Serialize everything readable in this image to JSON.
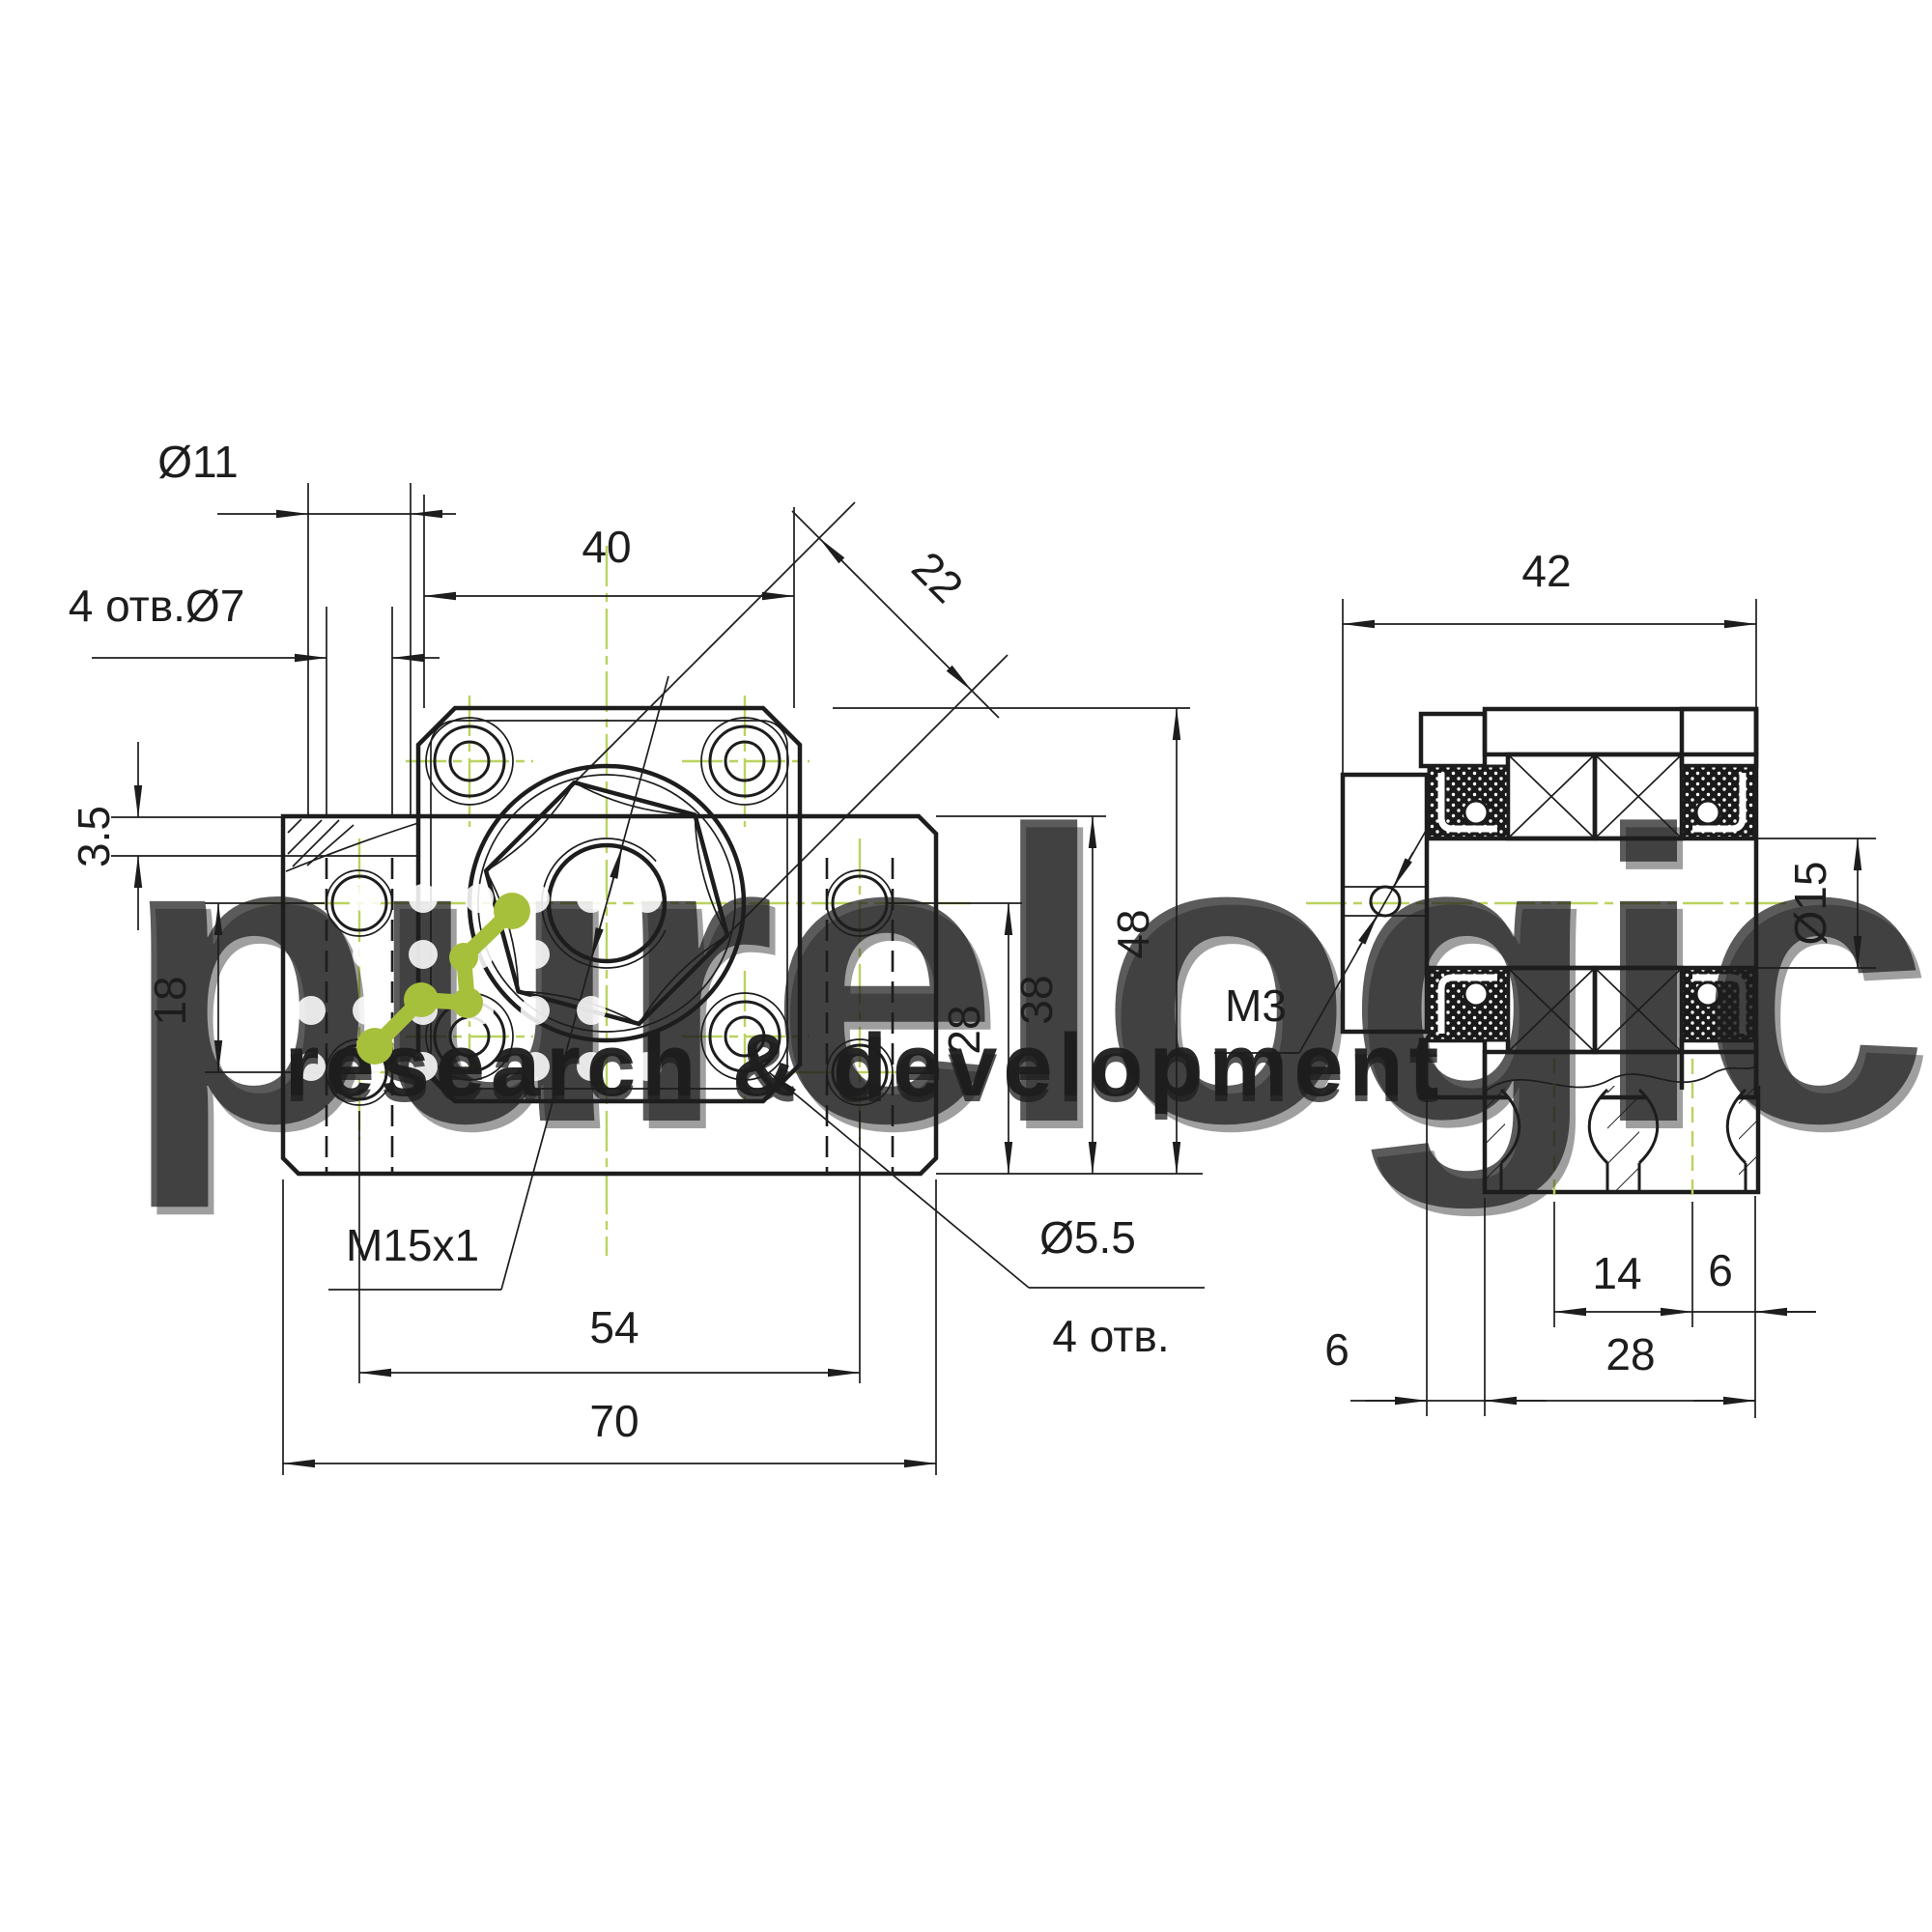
{
  "drawing": {
    "type": "technical-drawing",
    "component": "ballscrew-support-bearing-unit",
    "views": [
      "front",
      "side-section"
    ],
    "colors": {
      "line": "#1d1d1d",
      "centerline": "#b9d35f",
      "logo_green": "#a7c03c",
      "watermark_gray": "#e3e3e3"
    }
  },
  "dims": {
    "d11": {
      "t": "Ø11"
    },
    "h7": {
      "t": "4 отв.Ø7"
    },
    "d35": {
      "t": "3.5"
    },
    "d18": {
      "t": "18"
    },
    "d40": {
      "t": "40"
    },
    "d22": {
      "t": "22"
    },
    "m15": {
      "t": "M15x1"
    },
    "d54": {
      "t": "54"
    },
    "d70": {
      "t": "70"
    },
    "d55": {
      "t": "Ø5.5"
    },
    "h4": {
      "t": "4 отв."
    },
    "c28": {
      "t": "28"
    },
    "c38": {
      "t": "38"
    },
    "c48": {
      "t": "48"
    },
    "d42": {
      "t": "42"
    },
    "d15": {
      "t": "Ø15"
    },
    "m3": {
      "t": "M3"
    },
    "d14": {
      "t": "14"
    },
    "d6a": {
      "t": "6"
    },
    "d6b": {
      "t": "6"
    },
    "c28b": {
      "t": "28"
    }
  },
  "watermark": {
    "brand": "purelogic",
    "tagline": "research & development"
  }
}
